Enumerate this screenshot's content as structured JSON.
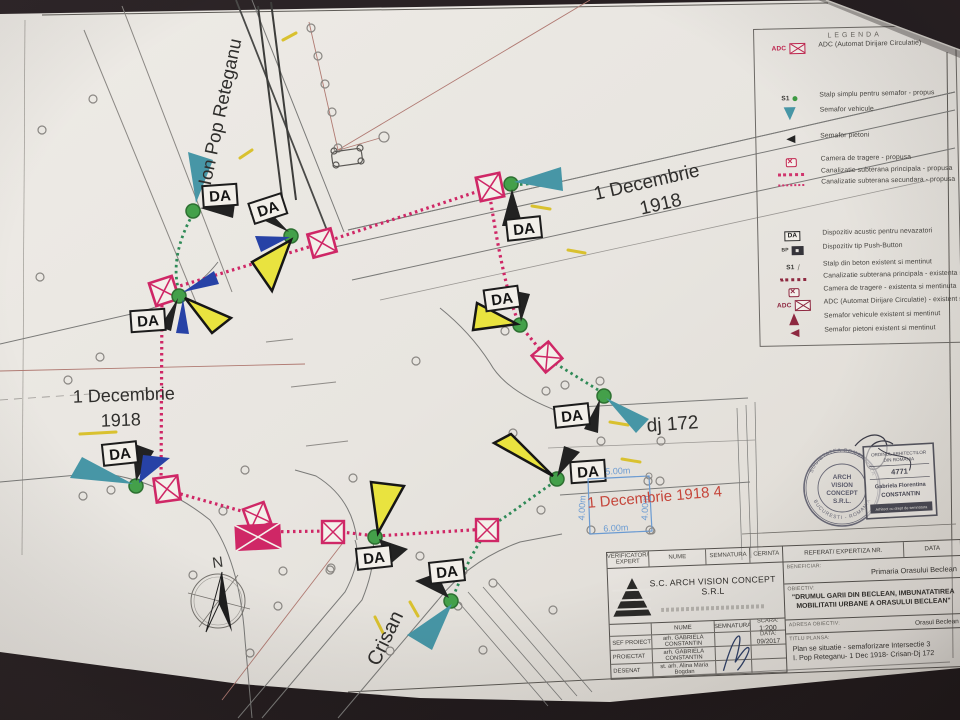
{
  "palette": {
    "paper": "#e8e5e0",
    "table_dark": "#241d20",
    "pink": "#cf2766",
    "maroon": "#8e2840",
    "green_post": "#44a04a",
    "green_duct": "#2f8a57",
    "teal": "#4796a6",
    "blue": "#2742a6",
    "yellow": "#e9e33f",
    "road": "#7a7a78",
    "red_label": "#c5453a",
    "dim_blue": "#6b9bd2"
  },
  "legend": {
    "title": "LEGENDA",
    "items": [
      {
        "icon": "adc-proposed-icon",
        "prefix": "ADC",
        "label": "ADC (Automat Dirijare Circulatie)"
      },
      {
        "icon": "simple-pole-icon",
        "prefix": "S1",
        "label": "Stalp simplu pentru semafor - propus"
      },
      {
        "icon": "vehicle-signal-icon",
        "label": "Semafor vehicule"
      },
      {
        "icon": "pedestrian-signal-icon",
        "label": "Semafor pietoni"
      },
      {
        "icon": "camera-icon",
        "label": "Camera de tragere - propusa"
      },
      {
        "icon": "main-duct-icon",
        "label": "Canalizatie subterana principala - propusa"
      },
      {
        "icon": "secondary-duct-icon",
        "label": "Canalizatie subterana secundara - propusa"
      },
      {
        "icon": "da-box-icon",
        "prefix": "DA",
        "label": "Dispozitiv acustic pentru nevazatori"
      },
      {
        "icon": "push-button-icon",
        "prefix": "BP",
        "label": "Dispozitiv tip Push-Button"
      },
      {
        "icon": "concrete-pole-icon",
        "prefix": "S1",
        "label": "Stalp din beton existent si mentinut"
      },
      {
        "icon": "existing-duct-icon",
        "label": "Canalizatie subterana principala - existenta si mentinuta"
      },
      {
        "icon": "existing-camera-icon",
        "label": "Camera de tragere - existenta si mentinuta"
      },
      {
        "icon": "adc-existing-icon",
        "prefix": "ADC",
        "label": "ADC (Automat Dirijare Circulatie) - existent si mentinut"
      },
      {
        "icon": "existing-vehicle-signal-icon",
        "label": "Semafor vehicule existent si mentinut"
      },
      {
        "icon": "existing-pedestrian-signal-icon",
        "label": "Semafor pietoni existent si mentinut"
      }
    ]
  },
  "plan": {
    "da_label": "DA",
    "north_label": "N",
    "streets": {
      "ion_pop": "Ion Pop Reteganu",
      "dec_ne_1": "1 Decembrie",
      "dec_ne_2": "1918",
      "dec_w_1": "1 Decembrie",
      "dec_w_2": "1918",
      "dj": "dj 172",
      "crisan": "Crisan",
      "red_label": "1 Decembrie 1918 4"
    },
    "dims": {
      "top": "5.00m",
      "left": "4.00m",
      "bottom": "6.00m",
      "right": "4.00m"
    }
  },
  "title_block": {
    "left": {
      "verificator1": "VERIFICATOR/",
      "verificator2": "EXPERT",
      "nume": "NUME",
      "semnatura": "SEMNATURA",
      "cerinta": "CERINTA",
      "company": "S.C. ARCH VISION CONCEPT S.R.L",
      "rows": [
        {
          "role": "SEF PROIECT",
          "name": "arh. GABRIELA CONSTANTIN"
        },
        {
          "role": "PROIECTAT",
          "name": "arh. GABRIELA CONSTANTIN"
        },
        {
          "role": "DESENAT",
          "name": "st. arh. Alina Maria Bogdan"
        }
      ],
      "scara_label": "SCARA:",
      "scara": "1:200",
      "data_label": "DATA:",
      "data": "09/2017"
    },
    "right": {
      "referat": "REFERAT/ EXPERTIZA NR.",
      "data": "DATA",
      "beneficiar_label": "BENEFICIAR:",
      "beneficiar": "Primaria Orasului Beclean",
      "obiectiv_label": "OBIECTIV:",
      "obiectiv": "\"DRUMUL GARII DIN BECLEAN, IMBUNATATIREA MOBILITATII URBANE A ORASULUI BECLEAN\"",
      "adresa_label": "ADRESA OBIECTIV:",
      "adresa": "Orasul Beclean",
      "titlu_label": "TITLU PLANSA:",
      "titlu1": "Plan se situatie - semaforizare Intersectie 3",
      "titlu2": "I. Pop Reteganu- 1 Dec 1918- Crisan-Dj 172"
    }
  },
  "stamps": {
    "round": {
      "top": "SOCIETATEA COMERCIALA",
      "bottom": "BUCURESTI - ROMANIA",
      "lines": [
        "ARCH",
        "VISION",
        "CONCEPT",
        "S.R.L."
      ]
    },
    "rect": {
      "org1": "ORDINUL ARHITECTILOR",
      "org2": "DIN ROMANIA",
      "number": "4771",
      "name1": "Gabriela Florentina",
      "name2": "CONSTANTIN",
      "footer": "Arhitect cu drept de semnatura"
    }
  }
}
